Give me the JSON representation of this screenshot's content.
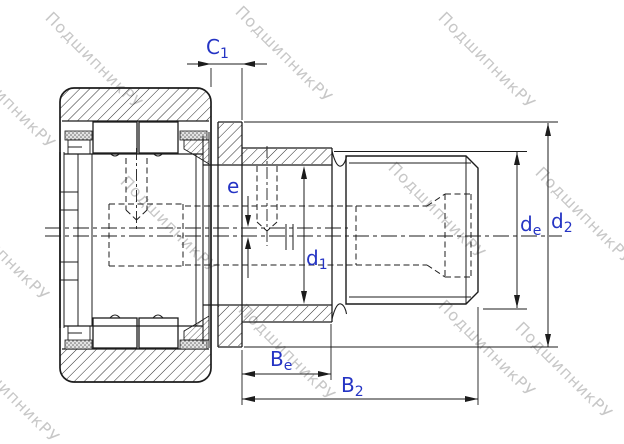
{
  "labels": {
    "c1": {
      "base": "C",
      "sub": "1"
    },
    "e": {
      "base": "e",
      "sub": ""
    },
    "d1": {
      "base": "d",
      "sub": "1"
    },
    "de": {
      "base": "d",
      "sub": "e"
    },
    "d2": {
      "base": "d",
      "sub": "2"
    },
    "be": {
      "base": "B",
      "sub": "e"
    },
    "b2": {
      "base": "B",
      "sub": "2"
    }
  },
  "dimensions_shown": [
    "C1",
    "e",
    "d1",
    "de",
    "d2",
    "Be",
    "B2"
  ],
  "watermark": {
    "text": "ПодшипникРУ",
    "color": "#c7c7c7"
  },
  "colors": {
    "line": "#1c1c1c",
    "dimension_label": "#2534c4",
    "background": "#ffffff"
  }
}
